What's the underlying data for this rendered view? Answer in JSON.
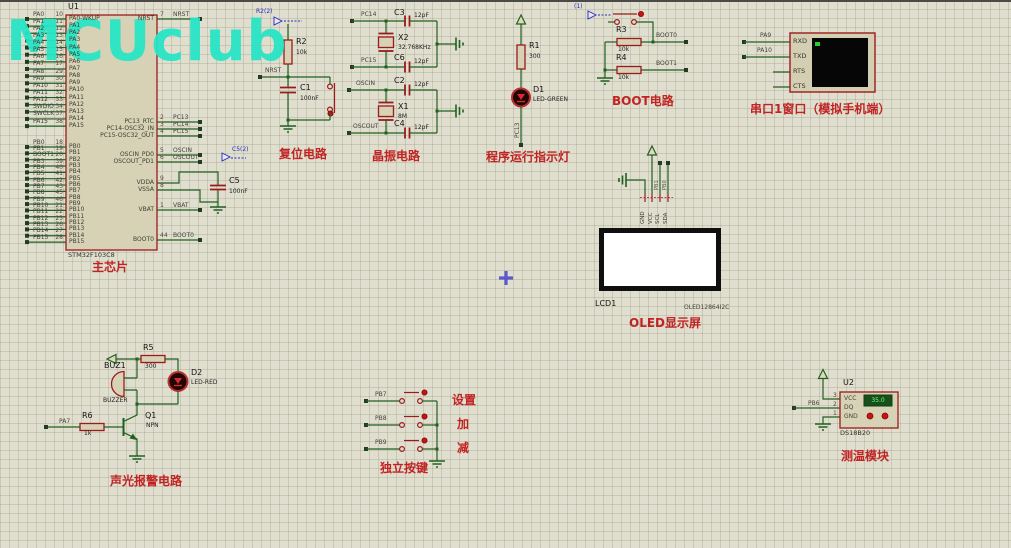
{
  "watermark": "MCUclub",
  "mcu": {
    "ref": "U1",
    "part": "STM32F103C8",
    "section": "主芯片",
    "left_pins": [
      {
        "net": "PA0",
        "num": "10",
        "name": "PA0-WKUP"
      },
      {
        "net": "PA1",
        "num": "11",
        "name": "PA1"
      },
      {
        "net": "PA2",
        "num": "12",
        "name": "PA2"
      },
      {
        "net": "PA3",
        "num": "13",
        "name": "PA3"
      },
      {
        "net": "PA4",
        "num": "14",
        "name": "PA4"
      },
      {
        "net": "PA5",
        "num": "15",
        "name": "PA5"
      },
      {
        "net": "PA6",
        "num": "16",
        "name": "PA6"
      },
      {
        "net": "PA7",
        "num": "17",
        "name": "PA7"
      },
      {
        "net": "PA8",
        "num": "29",
        "name": "PA8"
      },
      {
        "net": "PA9",
        "num": "30",
        "name": "PA9"
      },
      {
        "net": "PA10",
        "num": "31",
        "name": "PA10"
      },
      {
        "net": "PA11",
        "num": "32",
        "name": "PA11"
      },
      {
        "net": "PA12",
        "num": "33",
        "name": "PA12"
      },
      {
        "net": "SWDIO",
        "num": "34",
        "name": "PA13"
      },
      {
        "net": "SWCLK",
        "num": "37",
        "name": "PA14"
      },
      {
        "net": "PA15",
        "num": "38",
        "name": "PA15"
      },
      {
        "net": "PB0",
        "num": "18",
        "name": "PB0"
      },
      {
        "net": "PB1",
        "num": "19",
        "name": "PB1"
      },
      {
        "net": "BOOT1",
        "num": "20",
        "name": "PB2"
      },
      {
        "net": "PB3",
        "num": "39",
        "name": "PB3"
      },
      {
        "net": "PB4",
        "num": "40",
        "name": "PB4"
      },
      {
        "net": "PB5",
        "num": "41",
        "name": "PB5"
      },
      {
        "net": "PB6",
        "num": "42",
        "name": "PB6"
      },
      {
        "net": "PB7",
        "num": "43",
        "name": "PB7"
      },
      {
        "net": "PB8",
        "num": "45",
        "name": "PB8"
      },
      {
        "net": "PB9",
        "num": "46",
        "name": "PB9"
      },
      {
        "net": "PB10",
        "num": "21",
        "name": "PB10"
      },
      {
        "net": "PB11",
        "num": "22",
        "name": "PB11"
      },
      {
        "net": "PB12",
        "num": "25",
        "name": "PB12"
      },
      {
        "net": "PB13",
        "num": "26",
        "name": "PB13"
      },
      {
        "net": "PB14",
        "num": "27",
        "name": "PB14"
      },
      {
        "net": "PB15",
        "num": "28",
        "name": "PB15"
      }
    ],
    "right_pins": [
      {
        "name": "NRST",
        "num": "7",
        "net": "NRST"
      },
      {
        "name": "PC13_RTC",
        "num": "2",
        "net": "PC13"
      },
      {
        "name": "PC14-OSC32_IN",
        "num": "3",
        "net": "PC14"
      },
      {
        "name": "PC15-OSC32_OUT",
        "num": "4",
        "net": "PC15"
      },
      {
        "name": "OSCIN_PD0",
        "num": "5",
        "net": "OSCIN"
      },
      {
        "name": "OSCOUT_PD1",
        "num": "6",
        "net": "OSCOUT"
      },
      {
        "name": "VDDA",
        "num": "9",
        "net": ""
      },
      {
        "name": "VSSA",
        "num": "8",
        "net": ""
      },
      {
        "name": "VBAT",
        "num": "1",
        "net": "VBAT"
      },
      {
        "name": "BOOT0",
        "num": "44",
        "net": "BOOT0"
      }
    ],
    "c5": {
      "ref": "C5",
      "value": "100nF",
      "probe": "C5(2)"
    }
  },
  "reset": {
    "section": "复位电路",
    "probe": "R2(2)",
    "net": "NRST",
    "r2": {
      "ref": "R2",
      "value": "10k"
    },
    "c1": {
      "ref": "C1",
      "value": "100nF"
    }
  },
  "crystal": {
    "section": "晶振电路",
    "x2": {
      "ref": "X2",
      "value": "32.768KHz"
    },
    "x1": {
      "ref": "X1",
      "value": "8M"
    },
    "c3": {
      "ref": "C3",
      "value": "12pF"
    },
    "c6": {
      "ref": "C6",
      "value": "12pF"
    },
    "c2": {
      "ref": "C2",
      "value": "12pF"
    },
    "c4": {
      "ref": "C4",
      "value": "12pF"
    },
    "nets": {
      "pc14": "PC14",
      "pc15": "PC15",
      "oscin": "OSCIN",
      "oscout": "OSCOUT"
    }
  },
  "indicator": {
    "section": "程序运行指示灯",
    "net": "PC13",
    "r1": {
      "ref": "R1",
      "value": "300"
    },
    "d1": {
      "ref": "D1",
      "value": "LED-GREEN"
    }
  },
  "boot": {
    "section": "BOOT电路",
    "probe": "(1)",
    "r3": {
      "ref": "R3",
      "value": "10k"
    },
    "r4": {
      "ref": "R4",
      "value": "10k"
    },
    "nets": {
      "boot0": "BOOT0",
      "boot1": "BOOT1"
    }
  },
  "serial": {
    "section": "串口1窗口（模拟手机端）",
    "pins": [
      "RXD",
      "TXD",
      "RTS",
      "CTS"
    ],
    "nets": {
      "rxd": "PA9",
      "txd": "PA10"
    }
  },
  "oled": {
    "section": "OLED显示屏",
    "ref": "LCD1",
    "part": "OLED12864I2C",
    "pins": [
      "GND",
      "VCC",
      "SCL",
      "SDA"
    ],
    "nets": {
      "scl": "PB1",
      "sda": "PB0"
    }
  },
  "alarm": {
    "section": "声光报警电路",
    "net": "PA7",
    "buz": {
      "ref": "BUZ1",
      "value": "BUZZER"
    },
    "q1": {
      "ref": "Q1",
      "value": "NPN"
    },
    "r5": {
      "ref": "R5",
      "value": "300"
    },
    "r6": {
      "ref": "R6",
      "value": "1k"
    },
    "d2": {
      "ref": "D2",
      "value": "LED-RED"
    }
  },
  "keys": {
    "section": "独立按键",
    "rows": [
      {
        "net": "PB7",
        "label": "设置"
      },
      {
        "net": "PB8",
        "label": "加"
      },
      {
        "net": "PB9",
        "label": "减"
      }
    ]
  },
  "temp": {
    "section": "测温模块",
    "ref": "U2",
    "part": "DS18B20",
    "net": "PB6",
    "display": "35.0",
    "pins": [
      {
        "num": "3",
        "name": "VCC"
      },
      {
        "num": "2",
        "name": "DQ"
      },
      {
        "num": "1",
        "name": "GND"
      }
    ]
  },
  "colors": {
    "wire": "#206020",
    "component": "#9b1b1b",
    "section_label": "#c12323",
    "probe_blue": "#2a2ac0",
    "watermark": "#28e5c5"
  }
}
